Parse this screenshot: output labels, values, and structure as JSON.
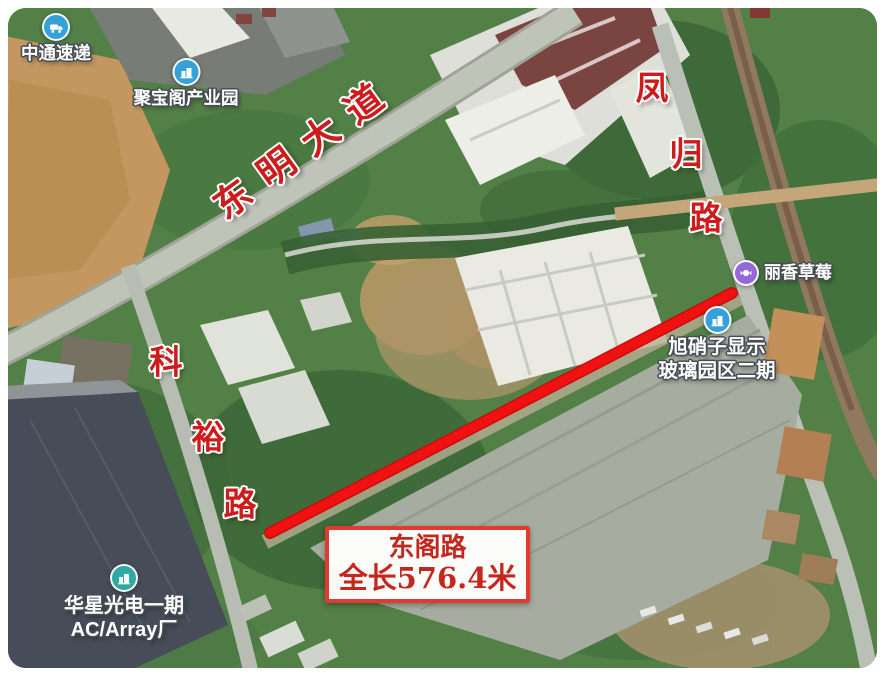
{
  "map": {
    "annotation_box": {
      "line1": "东阁路",
      "line2": "全长576.4米"
    },
    "road_labels": {
      "dongming": {
        "text": "东明大道"
      },
      "fenggui": {
        "chars": [
          "凤",
          "归",
          "路"
        ]
      },
      "keyu": {
        "chars": [
          "科",
          "裕",
          "路"
        ]
      }
    },
    "pois": {
      "zto": {
        "label": "中通速递"
      },
      "jubaoge": {
        "label": "聚宝阁产业园"
      },
      "lixiang": {
        "label": "丽香草莓"
      },
      "asahi": {
        "line1": "旭硝子显示",
        "line2": "玻璃园区二期"
      },
      "csot": {
        "line1": "华星光电一期",
        "line2": "AC/Array厂"
      }
    },
    "colors": {
      "highlight_red": "#f21111",
      "road_label_red": "#ce1b1b",
      "annotation_red": "#c3271d",
      "poi_blue": "#35a1d8",
      "poi_teal": "#2fa9a4",
      "poi_purple": "#9468d8"
    }
  }
}
